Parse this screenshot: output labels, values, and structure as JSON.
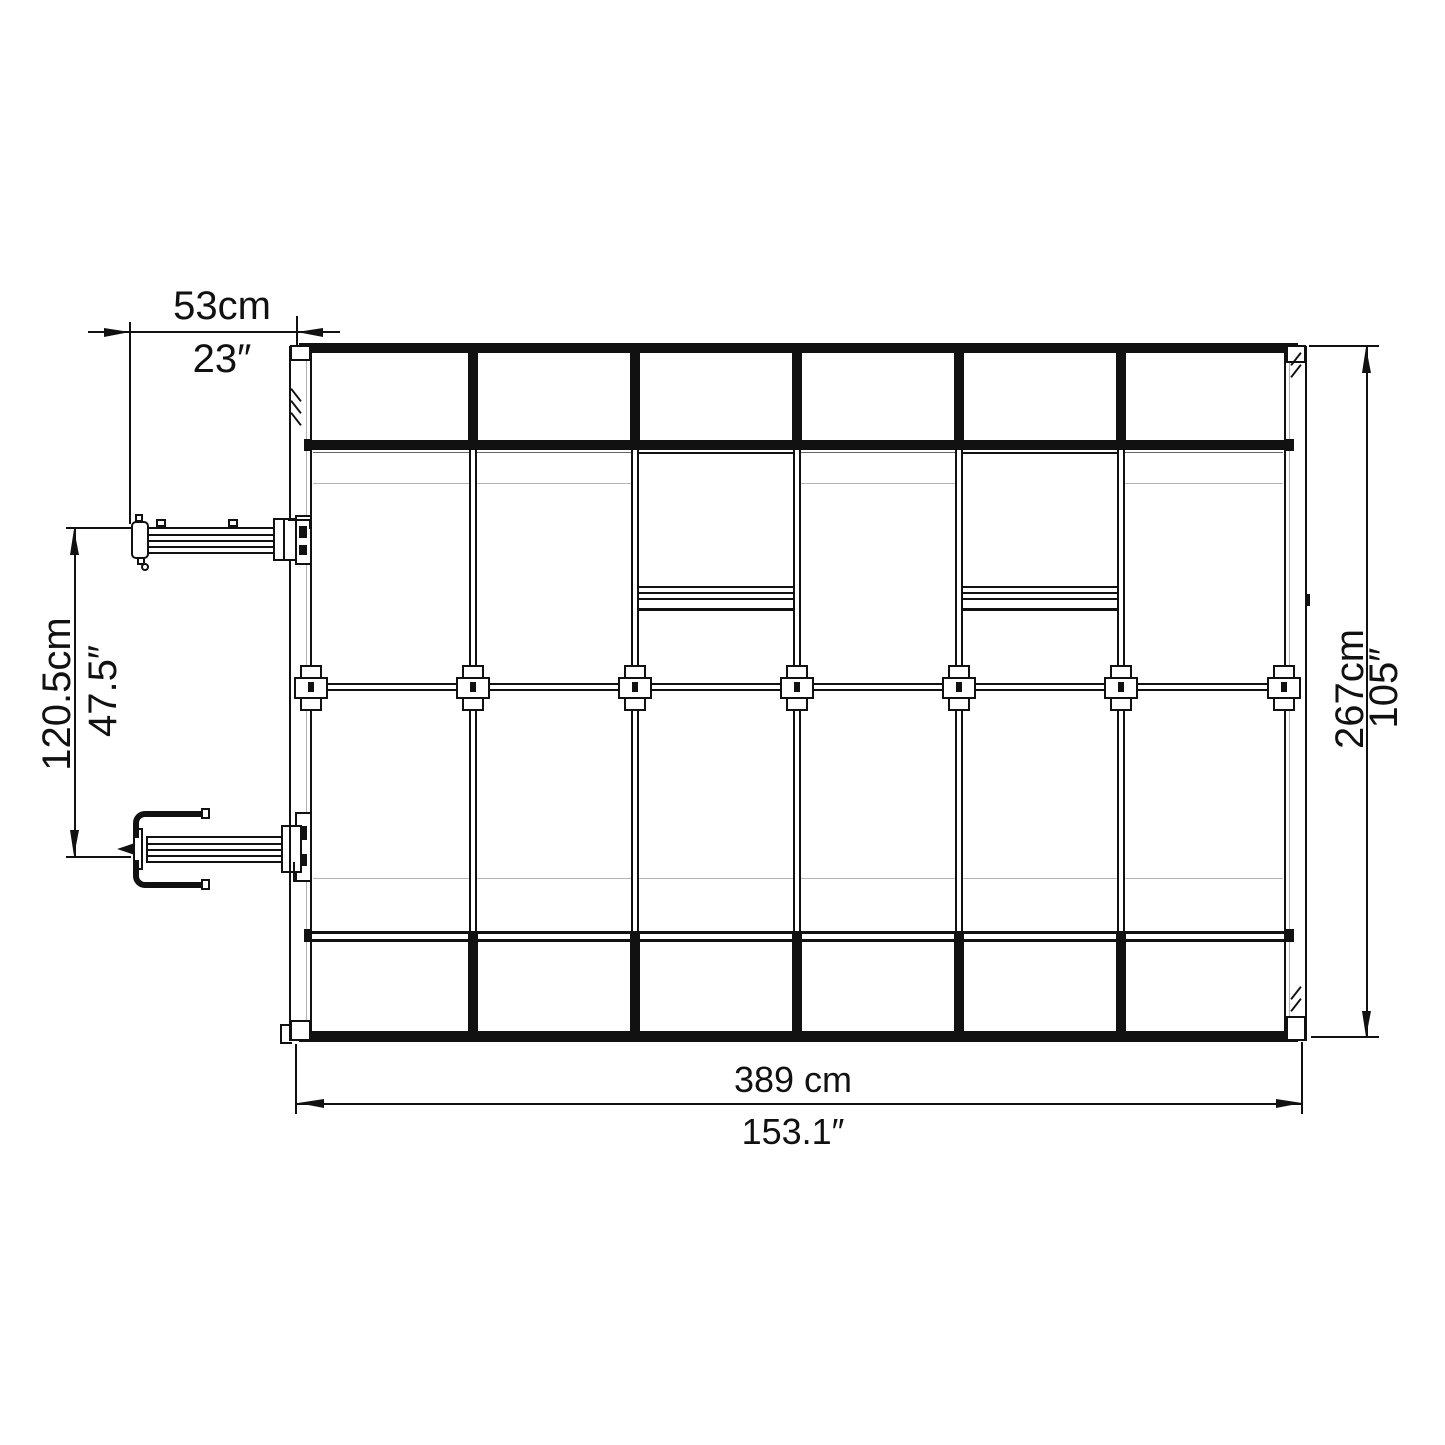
{
  "dimensions": {
    "top": {
      "metric": "53cm",
      "imperial": "23″"
    },
    "left": {
      "metric": "120.5cm",
      "imperial": "47.5″"
    },
    "right": {
      "metric": "267cm",
      "imperial": "105″"
    },
    "bottom": {
      "metric": "389 cm",
      "imperial": "153.1″"
    }
  },
  "colors": {
    "ink": "#111111",
    "faint_line": "#b3b3b3",
    "background": "#ffffff"
  }
}
